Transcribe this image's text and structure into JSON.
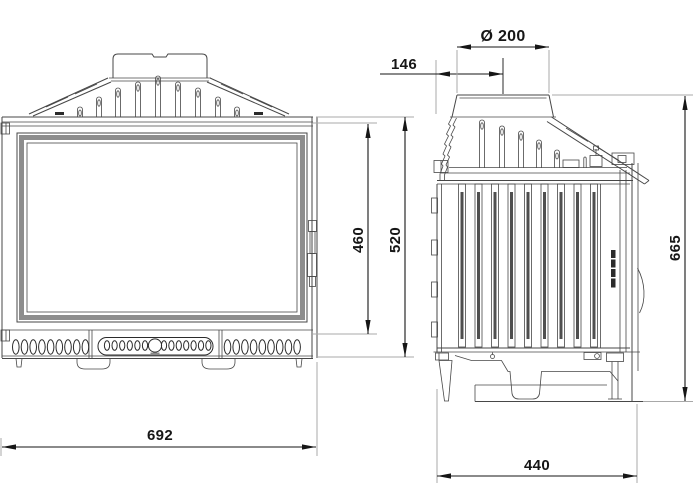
{
  "dimensions": {
    "front_width": "692",
    "door_height": "460",
    "front_height": "520",
    "flue_center_offset": "146",
    "flue_diameter": "Ø 200",
    "overall_height": "665",
    "depth": "440"
  },
  "colors": {
    "background": "#ffffff",
    "line": "#474747",
    "dark": "#2b2b2b",
    "dim": "#161616",
    "ext": "#a8a8a8",
    "frame": "#8d8d8d",
    "rib": "#4f4f4f"
  }
}
